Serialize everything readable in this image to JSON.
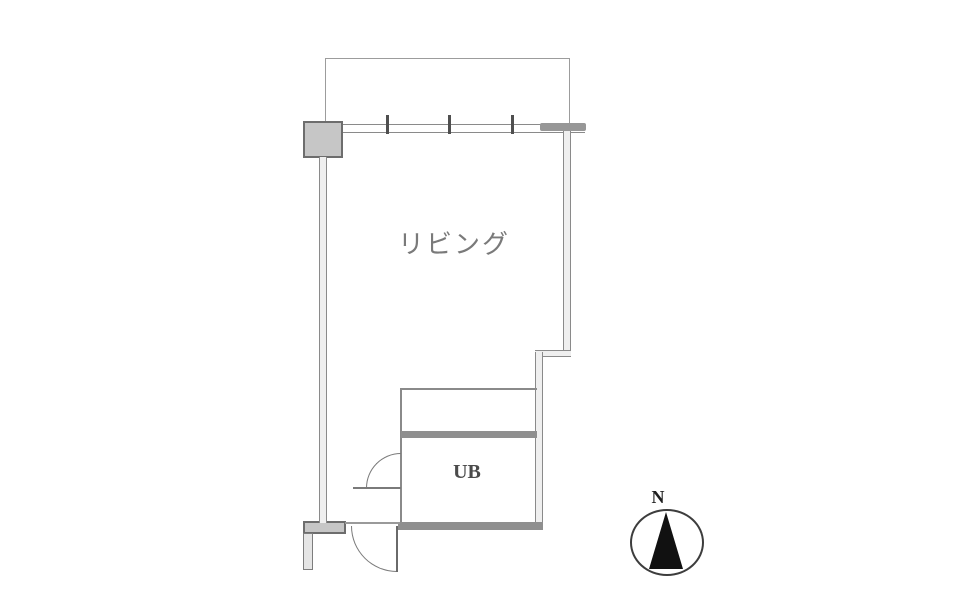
{
  "floorplan": {
    "rooms": {
      "living": "リビング",
      "unit_bath": "UB"
    },
    "compass": {
      "north": "N"
    },
    "colors": {
      "wall_solid": "#8f8f8f",
      "wall_line": "#8a8a8a",
      "pillar_fill": "#c6c6c6",
      "pillar_border": "#6d6d6d",
      "living_label_text": "#7a7a7a",
      "ub_label_text": "#4b4b4b",
      "compass_needle": "#111111",
      "background": "#ffffff"
    }
  }
}
